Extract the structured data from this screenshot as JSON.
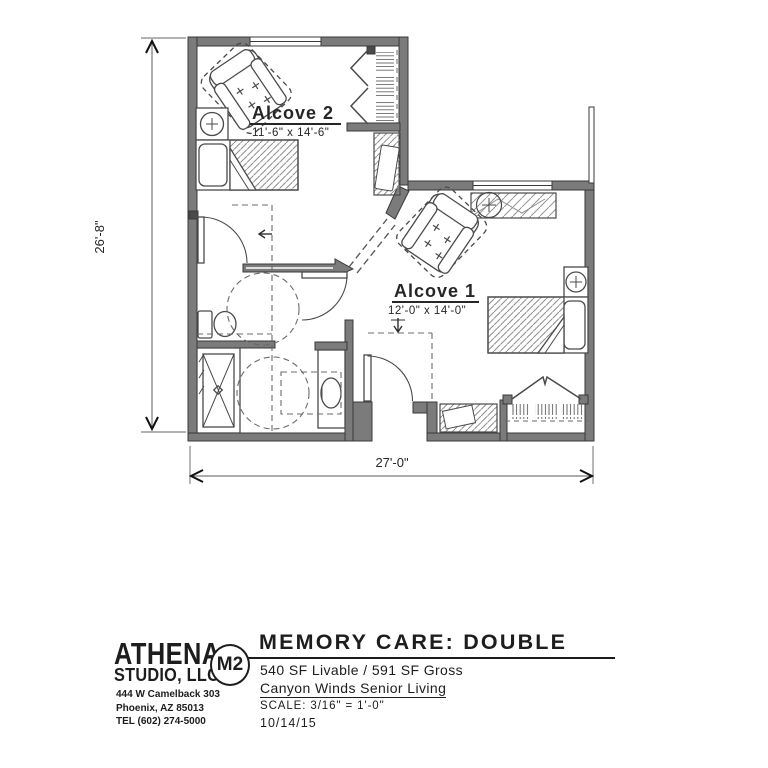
{
  "plan": {
    "alcove2": {
      "name": "Alcove 2",
      "dims": "11'-6\" x 14'-6\""
    },
    "alcove1": {
      "name": "Alcove 1",
      "dims": "12'-0\" x 14'-0\""
    },
    "dim_left": "26'-8\"",
    "dim_bottom": "27'-0\""
  },
  "title_block": {
    "firm_line1": "ATHENA",
    "firm_line2": "STUDIO, LLC",
    "address1": "444 W Camelback 303",
    "address2": "Phoenix, AZ 85013",
    "address3": "TEL (602) 274-5000",
    "sheet_code": "M2",
    "title": "MEMORY CARE: DOUBLE",
    "area_text": "540 SF Livable / 591 SF Gross",
    "project_name": "Canyon Winds Senior Living",
    "scale_text": "SCALE:  3/16\" = 1'-0\"",
    "date_text": "10/14/15"
  },
  "colors": {
    "wall_fill": "#7b7b7b",
    "wall_outline": "#3a3a3a",
    "furniture_line": "#4a4a4a",
    "text": "#262626"
  }
}
